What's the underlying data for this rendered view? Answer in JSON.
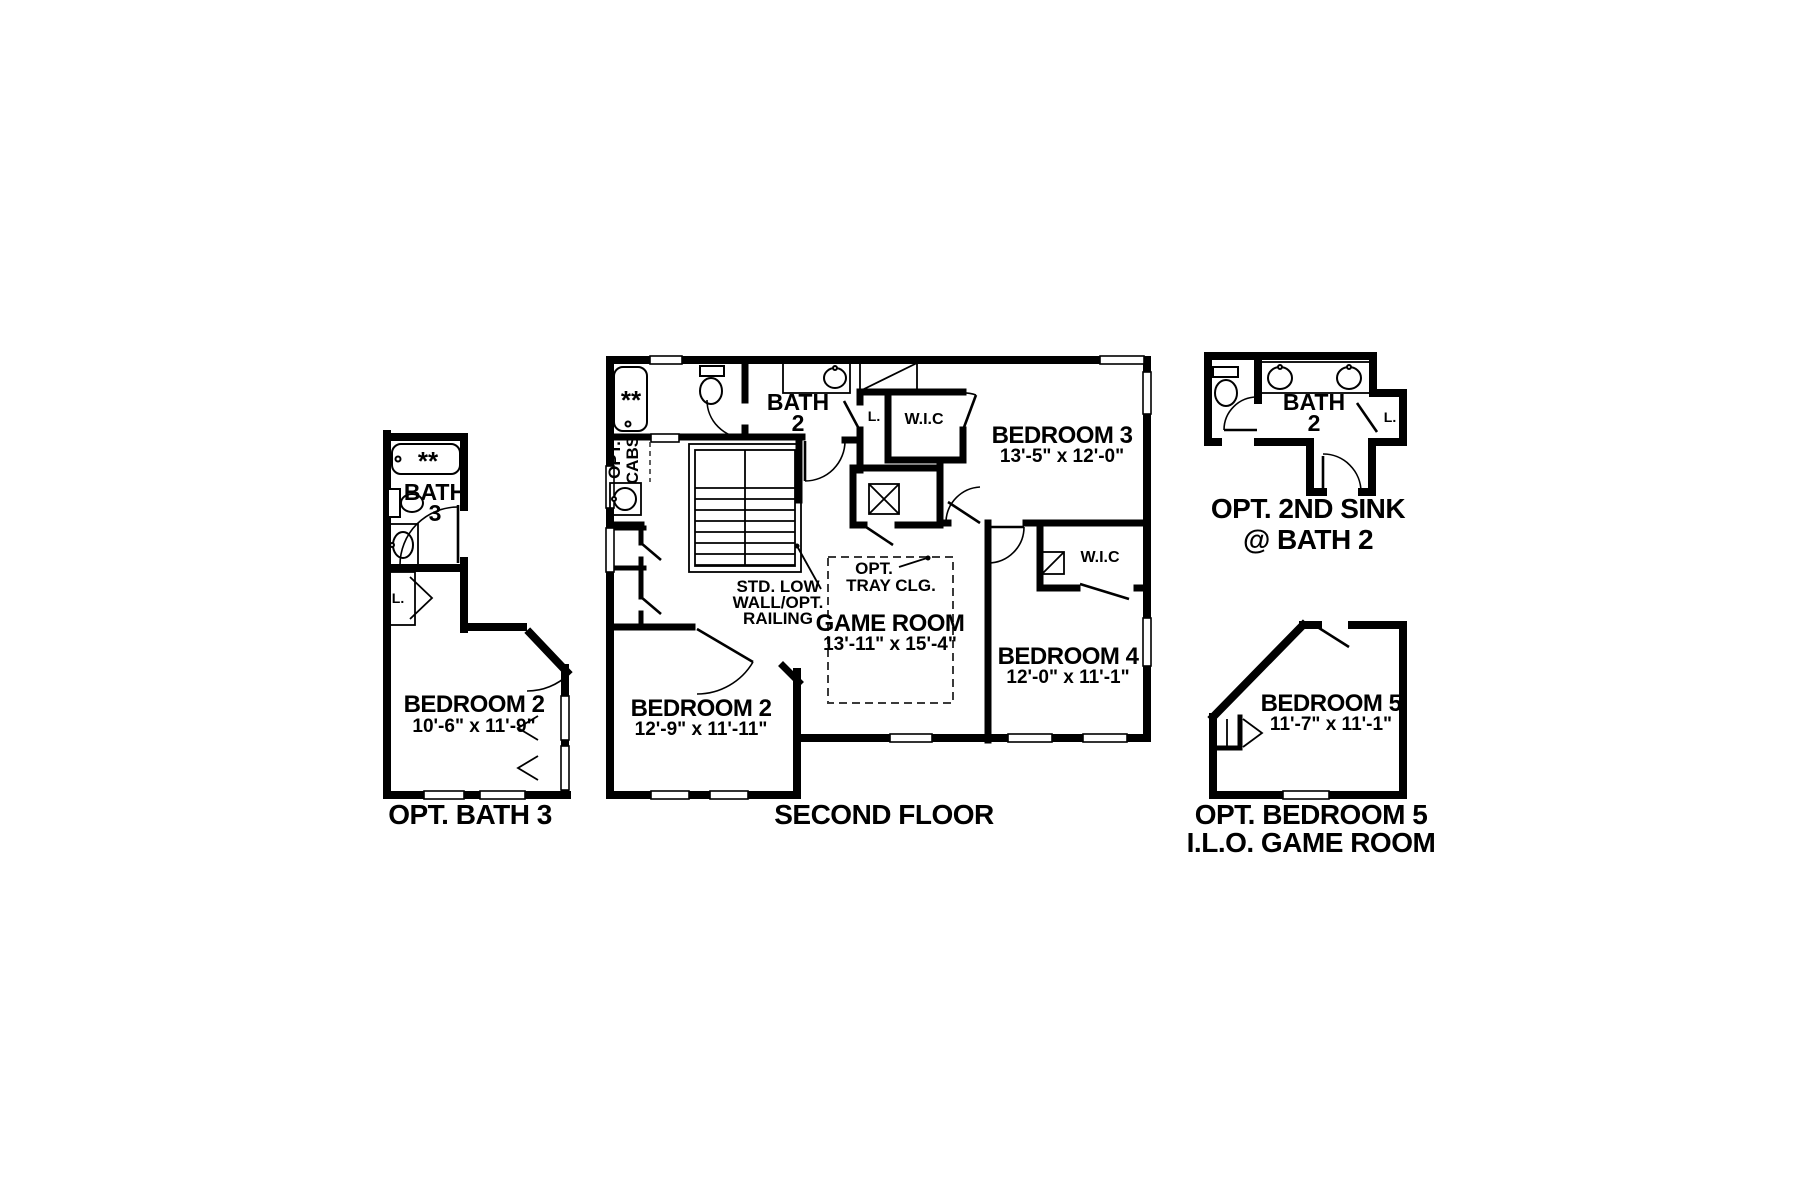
{
  "colors": {
    "wall": "#000000",
    "background": "#ffffff",
    "fixture": "#1a1a1a"
  },
  "plans": {
    "opt_bath3": {
      "caption": "OPT. BATH 3",
      "bath_line1": "BATH",
      "bath_line2": "3",
      "tub_stars": "**",
      "linen_label": "L.",
      "bedroom2_name": "BEDROOM 2",
      "bedroom2_dims": "10'-6\" x 11'-9\""
    },
    "second_floor": {
      "caption": "SECOND FLOOR",
      "tub_stars": "**",
      "opt_cabs_line1": "OPT.",
      "opt_cabs_line2": "CABS",
      "bath2_line1": "BATH",
      "bath2_line2": "2",
      "linen_label": "L.",
      "wic_label": "W.I.C",
      "bedroom3_name": "BEDROOM 3",
      "bedroom3_dims": "13'-5\" x 12'-0\"",
      "stair_note_line1": "STD. LOW",
      "stair_note_line2": "WALL/OPT.",
      "stair_note_line3": "RAILING",
      "tray_note_line1": "OPT.",
      "tray_note_line2": "TRAY CLG.",
      "game_room_name": "GAME ROOM",
      "game_room_dims": "13'-11\" x 15'-4\"",
      "bedroom4_name": "BEDROOM 4",
      "bedroom4_dims": "12'-0\" x 11'-1\"",
      "wic2_label": "W.I.C",
      "bedroom2_name": "BEDROOM 2",
      "bedroom2_dims": "12'-9\" x 11'-11\""
    },
    "opt_2nd_sink": {
      "caption_line1": "OPT. 2ND SINK",
      "caption_line2": "@ BATH 2",
      "bath2_line1": "BATH",
      "bath2_line2": "2",
      "linen_label": "L."
    },
    "opt_bedroom5": {
      "caption_line1": "OPT. BEDROOM 5",
      "caption_line2": "I.L.O. GAME ROOM",
      "bedroom5_name": "BEDROOM 5",
      "bedroom5_dims": "11'-7\" x 11'-1\""
    }
  }
}
